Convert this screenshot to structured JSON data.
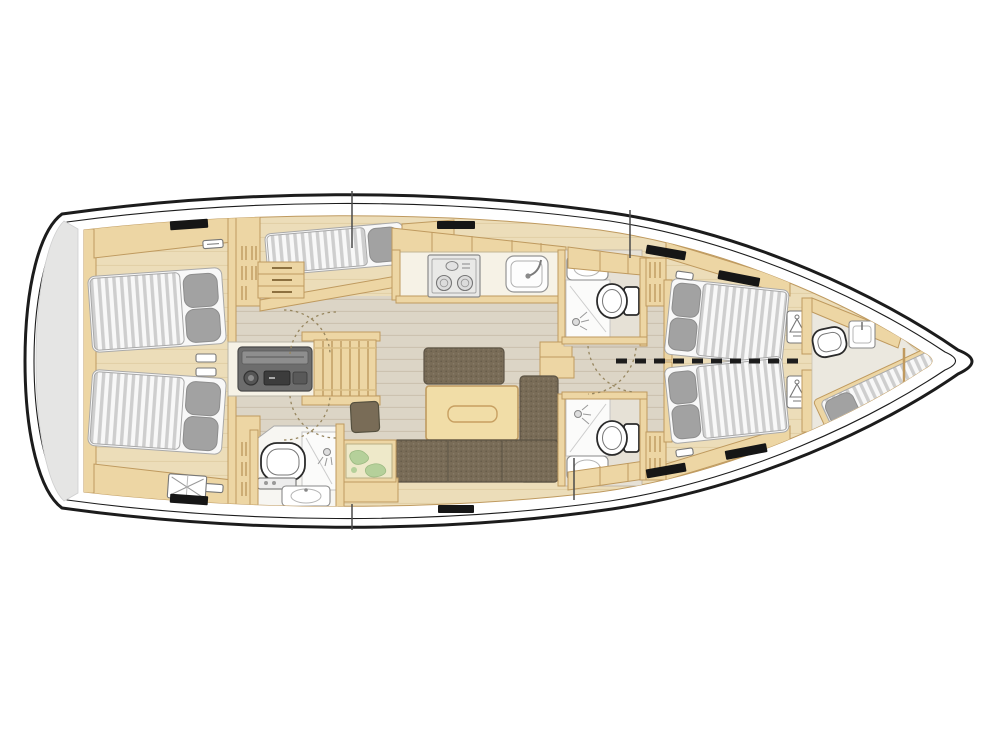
{
  "diagram": {
    "kind": "sailing-yacht-interior-floor-plan",
    "view": "top-down deck plan",
    "bow_direction": "right",
    "stern_direction": "left",
    "rooms": [
      {
        "id": "stern-platform",
        "label": "Stern swim platform"
      },
      {
        "id": "aft-cabin-port",
        "label": "Aft double cabin (top)",
        "features": [
          "double berth",
          "two pillows",
          "deck hatch",
          "shelving",
          "wardrobe louvers"
        ]
      },
      {
        "id": "aft-cabin-starboard",
        "label": "Aft double cabin (bottom)",
        "features": [
          "double berth",
          "two pillows",
          "deck hatch",
          "vent grille",
          "wardrobe louvers"
        ]
      },
      {
        "id": "single-berth-cabin",
        "label": "Single berth beside companionway",
        "features": [
          "single berth",
          "pillow",
          "step drawers"
        ]
      },
      {
        "id": "companionway",
        "label": "Companionway stairs with engine box",
        "features": [
          "steps",
          "engine / appliance front"
        ]
      },
      {
        "id": "galley",
        "label": "Galley",
        "features": [
          "two-burner stove",
          "sink with faucet",
          "overhead lockers"
        ]
      },
      {
        "id": "aft-head",
        "label": "Aft head (bottom)",
        "features": [
          "toilet",
          "shower",
          "sink"
        ]
      },
      {
        "id": "head-forward-top",
        "label": "Forward head (top)",
        "features": [
          "sink",
          "toilet",
          "shower"
        ]
      },
      {
        "id": "head-forward-bottom",
        "label": "Forward head (bottom)",
        "features": [
          "shower",
          "toilet",
          "sink"
        ]
      },
      {
        "id": "salon",
        "label": "Salon",
        "features": [
          "settee",
          "dining table",
          "L-shaped sofa",
          "stool",
          "chart table with map"
        ]
      },
      {
        "id": "forward-cabin-top",
        "label": "Forward berth (top)",
        "features": [
          "berth",
          "two pillows",
          "deck hatch",
          "wardrobe"
        ]
      },
      {
        "id": "forward-cabin-bottom",
        "label": "Forward berth (bottom)",
        "features": [
          "berth",
          "two pillows",
          "deck hatch",
          "wardrobe"
        ]
      },
      {
        "id": "bow-crew-cabin",
        "label": "Bow crew cabin",
        "features": [
          "diagonal single berth",
          "pillow",
          "toilet",
          "sink"
        ]
      }
    ],
    "annotations": [
      "dashed centerline divider between forward berths",
      "dashed quarter-circle door swings",
      "black deck hatches along coachroof"
    ]
  },
  "colors": {
    "hull_line": "#1c1c1c",
    "deck": "#ffffff",
    "interior_wood": "#ecddb9",
    "wood_grain": "#d6c194",
    "cabinet_wood": "#edd6a4",
    "wood_border": "#bf9a5f",
    "sole": "#dcd5c6",
    "sole_line": "#bdb29c",
    "mattress": "#f8f8f8",
    "mattress_stripe": "#c3c3c3",
    "mattress_edge": "#a9a9a9",
    "pillow": "#a2a2a2",
    "pillow_edge": "#8d8d8d",
    "sofa": "#796c57",
    "sofa_edge": "#5c5344",
    "table_wood": "#f1dda7",
    "counter": "#f6f2e6",
    "appliance_dark": "#6d6d6d",
    "fixture_line": "#8a8a8a",
    "toilet_line": "#2b2b2b",
    "stern_platform": "#e5e5e4",
    "chart_base": "#eee9c9",
    "chart_land": "#b5d09a",
    "hatch": "#161616",
    "door_arc": "#97865f"
  }
}
